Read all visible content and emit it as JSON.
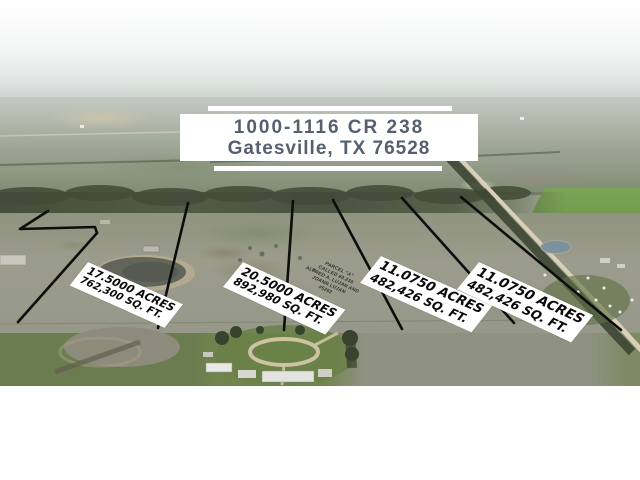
{
  "banner": {
    "line1": "1000-1116 CR 238",
    "line2": "Gatesville, TX 76528"
  },
  "parcels": [
    {
      "acres": "17.5000 ACRES",
      "sqft": "762,300 SQ. FT."
    },
    {
      "acres": "20.5000 ACRES",
      "sqft": "892,980 SQ. FT."
    },
    {
      "acres": "11.0750 ACRES",
      "sqft": "482,426 SQ. FT."
    },
    {
      "acres": "11.0750 ACRES",
      "sqft": "482,426 SQ. FT."
    }
  ],
  "survey_note": {
    "line1": "PARCEL \"A\"",
    "line2": "CALLED 60.230",
    "line3": "ALFRED A. LUJAN AND",
    "line4": "JOANN LUJAN",
    "line5": "#5292"
  },
  "colors": {
    "banner_text": "#56606e",
    "banner_background": "#ffffff",
    "boundary_line": "#0d0d0d",
    "label_background": "#ffffff",
    "label_text": "#090909"
  }
}
